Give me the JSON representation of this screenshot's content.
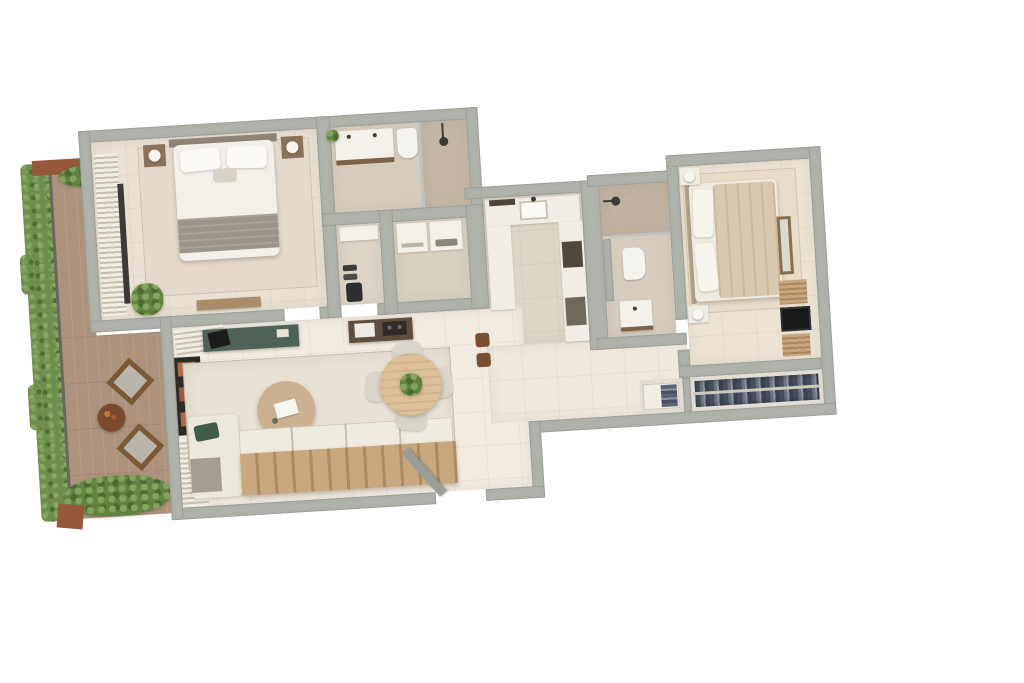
{
  "scene": {
    "type": "3d-floor-plan-render",
    "view": "top-down",
    "description": "Photorealistic top-down 3D render of a two-bedroom apartment floor plan with a planted side terrace; no text labels are rendered in the image",
    "background_color": "#ffffff"
  },
  "palette": {
    "wall": "#b0b3ac",
    "floor_cream": "#f1ebe2",
    "floor_beige": "#e9e0d3",
    "floor_greige": "#d6cdbf",
    "shower_tile": "#c0b3a1",
    "deck_wood": "#ad937d",
    "hedge_green": "#6f8e4e",
    "rug": "#e5dccb",
    "furniture_wood": "#b08d67",
    "console_green": "#4f6257",
    "counter_white": "#f2ede4",
    "counter_dark_wood": "#5e4d3e",
    "appliance_dark": "#50483e",
    "clothes_navy": "#46505f",
    "tv_black": "#17181a",
    "terracotta": "#b06a43",
    "planter_brown": "#96583a"
  },
  "terrace": {
    "features": [
      "boxwood hedge along outer edge",
      "glass balustrade rail",
      "wood deck boards",
      "planter with shrubs at top",
      "planter with shrubs at bottom",
      "two lounge armchairs set diagonally",
      "round coffee table with fruit bowl"
    ]
  },
  "rooms": {
    "bedroom_1": {
      "furniture": [
        "double bed with white duvet and grey foot throw",
        "two pillows",
        "headboard",
        "left nightstand with lamp",
        "right nightstand with lamp",
        "slatted wardrobe along terrace wall",
        "glazed door to terrace",
        "area rug",
        "potted plant",
        "low wood bench"
      ]
    },
    "bathroom_1": {
      "furniture": [
        "double-sink vanity with wood base and plant",
        "toilet",
        "walk-in shower with glass screen and shower head"
      ]
    },
    "hallway": {
      "furniture": [
        "white storage cabinet",
        "pairs of shoes",
        "dark bag"
      ]
    },
    "laundry": {
      "furniture": [
        "washing machine",
        "dryer"
      ]
    },
    "kitchen": {
      "furniture": [
        "U-shaped white counter",
        "sink with faucet",
        "dark cooker hood strip",
        "tall oven unit",
        "dishwasher front",
        "two wood bar stools at pass-through counter"
      ]
    },
    "bathroom_2": {
      "furniture": [
        "walk-in shower with dark tile and shower head",
        "privacy nib wall",
        "toilet",
        "single sink vanity"
      ]
    },
    "bedroom_2": {
      "furniture": [
        "double bed with beige duvet, head at left wall",
        "stacked pillows",
        "nightstand with lamp top",
        "nightstand with lamp bottom",
        "area rug",
        "wood framed mirror on right wall",
        "slatted dresser",
        "flat TV on sideboard",
        "second slatted unit"
      ]
    },
    "living_dining": {
      "furniture": [
        "louvered blind in terrace corner",
        "dark shelving with terracotta books",
        "white slatted screen",
        "green console desk with black laptop",
        "dark wood kitchenette counter with sink and hob",
        "large area rug",
        "round wood coffee table with open book",
        "sofa with wood slat back, seat cushions, chaise, green pillow and grey throw",
        "round dining table with centerpiece plant",
        "four upholstered dining chairs",
        "open entrance door leaf"
      ]
    },
    "corridor": {
      "furniture": [
        "small open closet with folded clothes",
        "long built-in wardrobe with hanging clothes on rail"
      ]
    }
  }
}
